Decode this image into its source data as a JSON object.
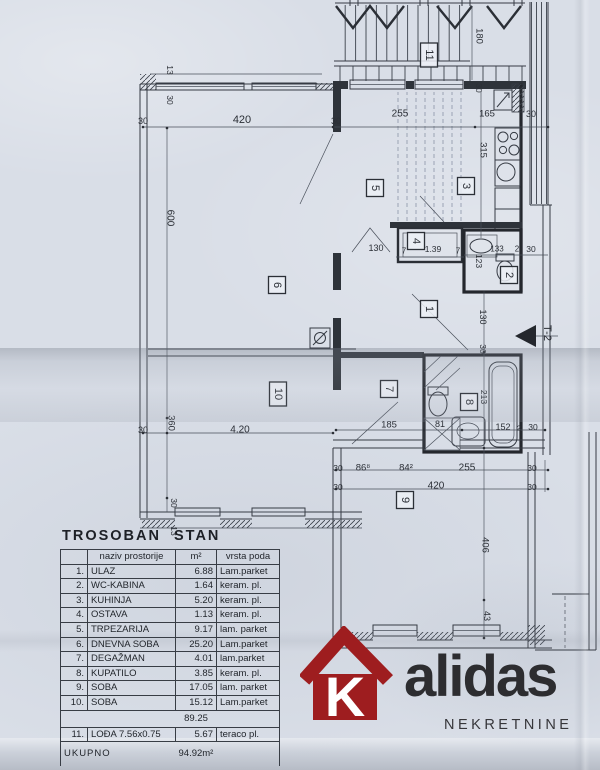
{
  "document": {
    "section_marker": "T-2",
    "paper_color": "#d9dee7",
    "line_color": "#363b44"
  },
  "plan": {
    "room_numbers": [
      {
        "n": "1",
        "x": 429,
        "y": 309
      },
      {
        "n": "2",
        "x": 509,
        "y": 275
      },
      {
        "n": "3",
        "x": 466,
        "y": 186
      },
      {
        "n": "4",
        "x": 416,
        "y": 241
      },
      {
        "n": "5",
        "x": 375,
        "y": 188
      },
      {
        "n": "6",
        "x": 277,
        "y": 285
      },
      {
        "n": "7",
        "x": 389,
        "y": 389
      },
      {
        "n": "8",
        "x": 469,
        "y": 402
      },
      {
        "n": "9",
        "x": 405,
        "y": 500
      },
      {
        "n": "10",
        "x": 278,
        "y": 394
      },
      {
        "n": "11",
        "x": 429,
        "y": 55
      }
    ],
    "dim_labels": [
      {
        "t": "13",
        "x": 170,
        "y": 70,
        "r": 90,
        "s": 8.5
      },
      {
        "t": "30",
        "x": 170,
        "y": 100,
        "r": 90,
        "s": 8.5
      },
      {
        "t": "30",
        "x": 143,
        "y": 121,
        "r": 0,
        "s": 9
      },
      {
        "t": "420",
        "x": 242,
        "y": 120,
        "r": 0,
        "s": 11
      },
      {
        "t": "30",
        "x": 336,
        "y": 121,
        "r": 0,
        "s": 9
      },
      {
        "t": "255",
        "x": 400,
        "y": 114,
        "r": 0,
        "s": 10
      },
      {
        "t": "165",
        "x": 487,
        "y": 114,
        "r": 0,
        "s": 9.5
      },
      {
        "t": "30",
        "x": 531,
        "y": 114,
        "r": 0,
        "s": 9
      },
      {
        "t": "180",
        "x": 479,
        "y": 36,
        "r": 90,
        "s": 9.5
      },
      {
        "t": "30",
        "x": 479,
        "y": 88,
        "r": 90,
        "s": 8.5
      },
      {
        "t": "315",
        "x": 483,
        "y": 150,
        "r": 90,
        "s": 9.5
      },
      {
        "t": "600",
        "x": 170,
        "y": 218,
        "r": 90,
        "s": 10
      },
      {
        "t": "130",
        "x": 376,
        "y": 248,
        "r": 0,
        "s": 9
      },
      {
        "t": "7",
        "x": 404,
        "y": 251,
        "r": 0,
        "s": 8
      },
      {
        "t": "1.39",
        "x": 433,
        "y": 249,
        "r": 0,
        "s": 8.5
      },
      {
        "t": "7",
        "x": 458,
        "y": 251,
        "r": 0,
        "s": 8
      },
      {
        "t": "133",
        "x": 497,
        "y": 249,
        "r": 0,
        "s": 8
      },
      {
        "t": "2",
        "x": 517,
        "y": 249,
        "r": 0,
        "s": 8
      },
      {
        "t": "30",
        "x": 531,
        "y": 249,
        "r": 0,
        "s": 8.5
      },
      {
        "t": "123",
        "x": 479,
        "y": 261,
        "r": 90,
        "s": 8.5
      },
      {
        "t": "130",
        "x": 483,
        "y": 317,
        "r": 90,
        "s": 9
      },
      {
        "t": "30",
        "x": 483,
        "y": 349,
        "r": 90,
        "s": 8.5
      },
      {
        "t": "T-2",
        "x": 547,
        "y": 333,
        "r": 90,
        "s": 11
      },
      {
        "t": "213",
        "x": 484,
        "y": 397,
        "r": 90,
        "s": 8.5
      },
      {
        "t": "185",
        "x": 389,
        "y": 425,
        "r": 0,
        "s": 9.5
      },
      {
        "t": "81",
        "x": 440,
        "y": 424,
        "r": 0,
        "s": 9
      },
      {
        "t": "152",
        "x": 503,
        "y": 427,
        "r": 0,
        "s": 9
      },
      {
        "t": "2",
        "x": 519,
        "y": 428,
        "r": 0,
        "s": 7.5
      },
      {
        "t": "30",
        "x": 533,
        "y": 427,
        "r": 0,
        "s": 8.5
      },
      {
        "t": "360",
        "x": 171,
        "y": 423,
        "r": 90,
        "s": 9.5
      },
      {
        "t": "30",
        "x": 143,
        "y": 430,
        "r": 0,
        "s": 9
      },
      {
        "t": "4.20",
        "x": 240,
        "y": 430,
        "r": 0,
        "s": 10
      },
      {
        "t": "30",
        "x": 338,
        "y": 468,
        "r": 0,
        "s": 8.5
      },
      {
        "t": "86⁸",
        "x": 363,
        "y": 468,
        "r": 0,
        "s": 9.5
      },
      {
        "t": "84²",
        "x": 406,
        "y": 468,
        "r": 0,
        "s": 9.5
      },
      {
        "t": "255",
        "x": 467,
        "y": 468,
        "r": 0,
        "s": 10
      },
      {
        "t": "30",
        "x": 532,
        "y": 468,
        "r": 0,
        "s": 8.5
      },
      {
        "t": "30",
        "x": 338,
        "y": 487,
        "r": 0,
        "s": 8.5
      },
      {
        "t": "420",
        "x": 436,
        "y": 486,
        "r": 0,
        "s": 10
      },
      {
        "t": "30",
        "x": 532,
        "y": 487,
        "r": 0,
        "s": 8.5
      },
      {
        "t": "30",
        "x": 174,
        "y": 503,
        "r": 90,
        "s": 8.5
      },
      {
        "t": "13",
        "x": 174,
        "y": 531,
        "r": 90,
        "s": 8.5
      },
      {
        "t": "406",
        "x": 485,
        "y": 545,
        "r": 90,
        "s": 9.5
      },
      {
        "t": "43",
        "x": 487,
        "y": 616,
        "r": 90,
        "s": 9
      }
    ]
  },
  "table": {
    "title": "TROSOBAN STAN",
    "columns": [
      "naziv prostorije",
      "m²",
      "vrsta poda"
    ],
    "rows": [
      {
        "num": "1.",
        "name": "ULAZ",
        "area": "6.88",
        "floor": "Lam.parket"
      },
      {
        "num": "2.",
        "name": "WC-KABINA",
        "area": "1.64",
        "floor": "keram. pl."
      },
      {
        "num": "3.",
        "name": "KUHINJA",
        "area": "5.20",
        "floor": "keram. pl."
      },
      {
        "num": "4.",
        "name": "OSTAVA",
        "area": "1.13",
        "floor": "keram. pl."
      },
      {
        "num": "5.",
        "name": "TRPEZARIJA",
        "area": "9.17",
        "floor": "lam. parket"
      },
      {
        "num": "6.",
        "name": "DNEVNA SOBA",
        "area": "25.20",
        "floor": "Lam.parket"
      },
      {
        "num": "7.",
        "name": "DEGAŽMAN",
        "area": "4.01",
        "floor": "lam.parket"
      },
      {
        "num": "8.",
        "name": "KUPATILO",
        "area": "3.85",
        "floor": "keram. pl."
      },
      {
        "num": "9.",
        "name": "SOBA",
        "area": "17.05",
        "floor": "lam. parket"
      },
      {
        "num": "10.",
        "name": "SOBA",
        "area": "15.12",
        "floor": "Lam.parket"
      }
    ],
    "subtotal": "89.25",
    "loggia_row": {
      "num": "11.",
      "name": "LOĐA 7.56x0.75",
      "area": "5.67",
      "floor": "teraco pl."
    },
    "total_label": "UKUPNO",
    "total_value": "94.92m²"
  },
  "logo": {
    "house_letter": "K",
    "name_rest": "alidas",
    "subtitle": "NEKRETNINE",
    "house_color": "#9e1d1f",
    "text_color": "#2d2d30"
  }
}
